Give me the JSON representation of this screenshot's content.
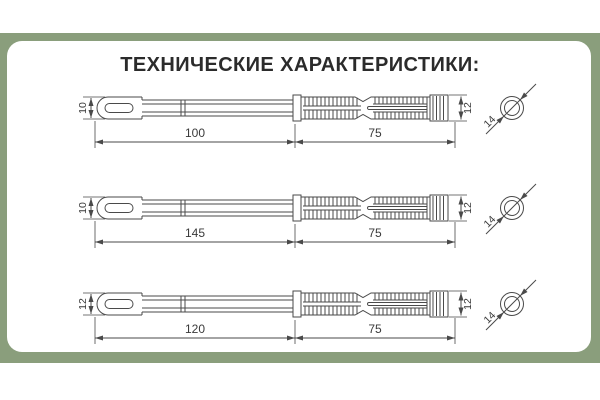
{
  "title": "ТЕХНИЧЕСКИЕ ХАРАКТЕРИСТИКИ:",
  "colors": {
    "frame_green": "#8a9e7c",
    "drawing_line": "#4a4a4a",
    "title_text": "#2b2b2b"
  },
  "rows": [
    {
      "head_height": "10",
      "shaft_length": "100",
      "dowel_length": "75",
      "dowel_height": "12",
      "diameter": "14"
    },
    {
      "head_height": "10",
      "shaft_length": "145",
      "dowel_length": "75",
      "dowel_height": "12",
      "diameter": "14"
    },
    {
      "head_height": "12",
      "shaft_length": "120",
      "dowel_length": "75",
      "dowel_height": "12",
      "diameter": "14"
    }
  ]
}
